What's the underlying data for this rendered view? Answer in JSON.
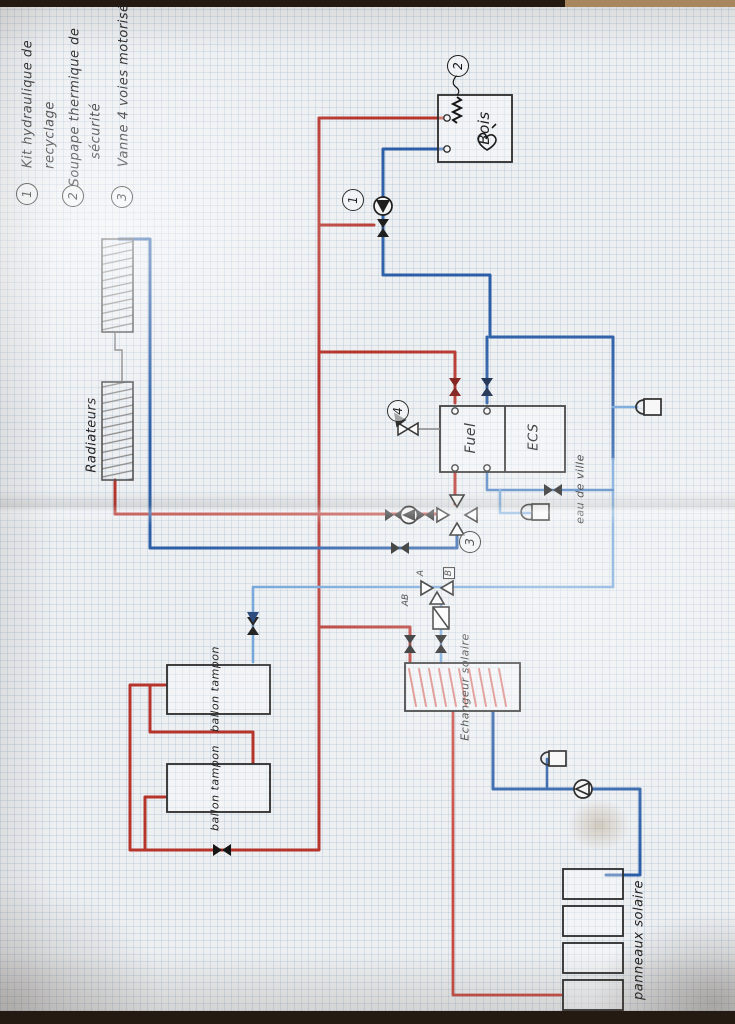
{
  "legend": {
    "items": [
      {
        "num": "1",
        "line1": "Kit hydraulique de",
        "line2": "recyclage"
      },
      {
        "num": "2",
        "line1": "Soupape thermique de",
        "line2": "sécurité"
      },
      {
        "num": "3",
        "line1": "Vanne 4 voies motorisée",
        "line2": ""
      }
    ]
  },
  "labels": {
    "radiators": "Radiateurs",
    "wood_boiler": "Bois",
    "fuel_boiler": "Fuel",
    "dhw_tank": "ECS",
    "city_water": "eau de ville",
    "buffer_tank_1": "ballon tampon",
    "buffer_tank_2": "ballon tampon",
    "solar_exchanger": "Echangeur solaire",
    "solar_panels": "panneaux solaire"
  },
  "callouts": {
    "recycling_kit": "1",
    "thermal_safety_valve": "2",
    "four_way_valve": "3",
    "fuel_mixing_valve": "4"
  },
  "mixing_ports": {
    "a": "A",
    "ab": "AB",
    "b": "B"
  },
  "colors": {
    "hot_pipe": "#b5342c",
    "hot_pipe_light": "#c84b42",
    "return_pipe": "#2b5ea7",
    "cold_pipe": "#6fa3d8",
    "ink": "#1c1c1c",
    "pencil": "#8a8a8a",
    "paper": "#edeff1",
    "grid": "#82a0c3"
  }
}
